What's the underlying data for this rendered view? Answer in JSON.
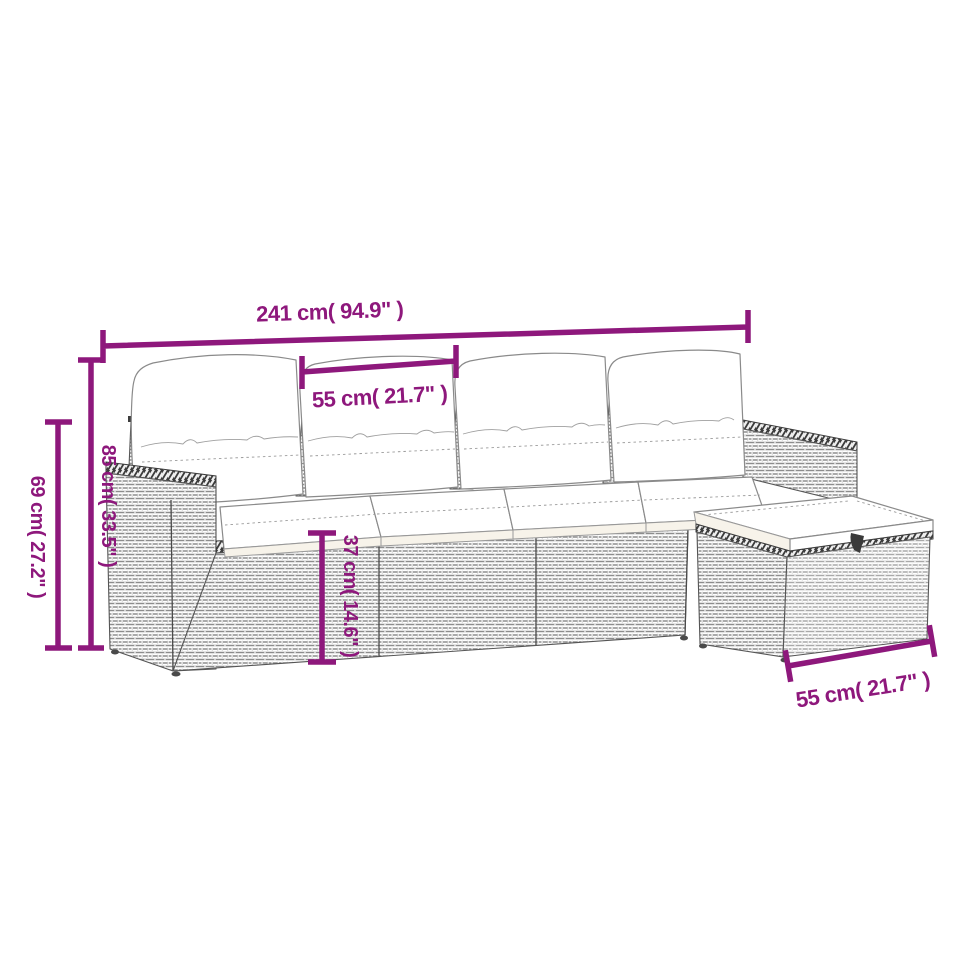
{
  "image": {
    "kind": "product dimension diagram",
    "subject": "5-piece poly rattan garden lounge sofa set with white cushions and footstool",
    "style": "grey wicker line-art drawing with magenta dimension annotations on white background"
  },
  "colors": {
    "background": "#ffffff",
    "dimension_accent": "#8E187C",
    "line_art": "#4a4a4a",
    "wicker_texture": "#8d8d8d",
    "cushion_fill": "#ffffff"
  },
  "dimensions": {
    "overall_width": {
      "label": "241 cm( 94.9\" )",
      "orientation": "horizontal",
      "location": "top, full width of sofa"
    },
    "seat_width": {
      "label": "55 cm( 21.7\" )",
      "orientation": "horizontal",
      "location": "top, between two back posts"
    },
    "back_height": {
      "label": "85 cm( 33.5\" )",
      "orientation": "vertical",
      "location": "left, total height"
    },
    "arm_height": {
      "label": "69 cm( 27.2\" )",
      "orientation": "vertical",
      "location": "far left, armrest height"
    },
    "seat_height": {
      "label": "37 cm( 14.6\" )",
      "orientation": "vertical",
      "location": "middle, seat base height"
    },
    "footstool_width": {
      "label": "55 cm( 21.7\" )",
      "orientation": "horizontal",
      "location": "bottom right, footstool width"
    }
  },
  "parts": {
    "back_cushions": 4,
    "seat_cushions": 4,
    "armrests": 2,
    "footstool": 1
  }
}
